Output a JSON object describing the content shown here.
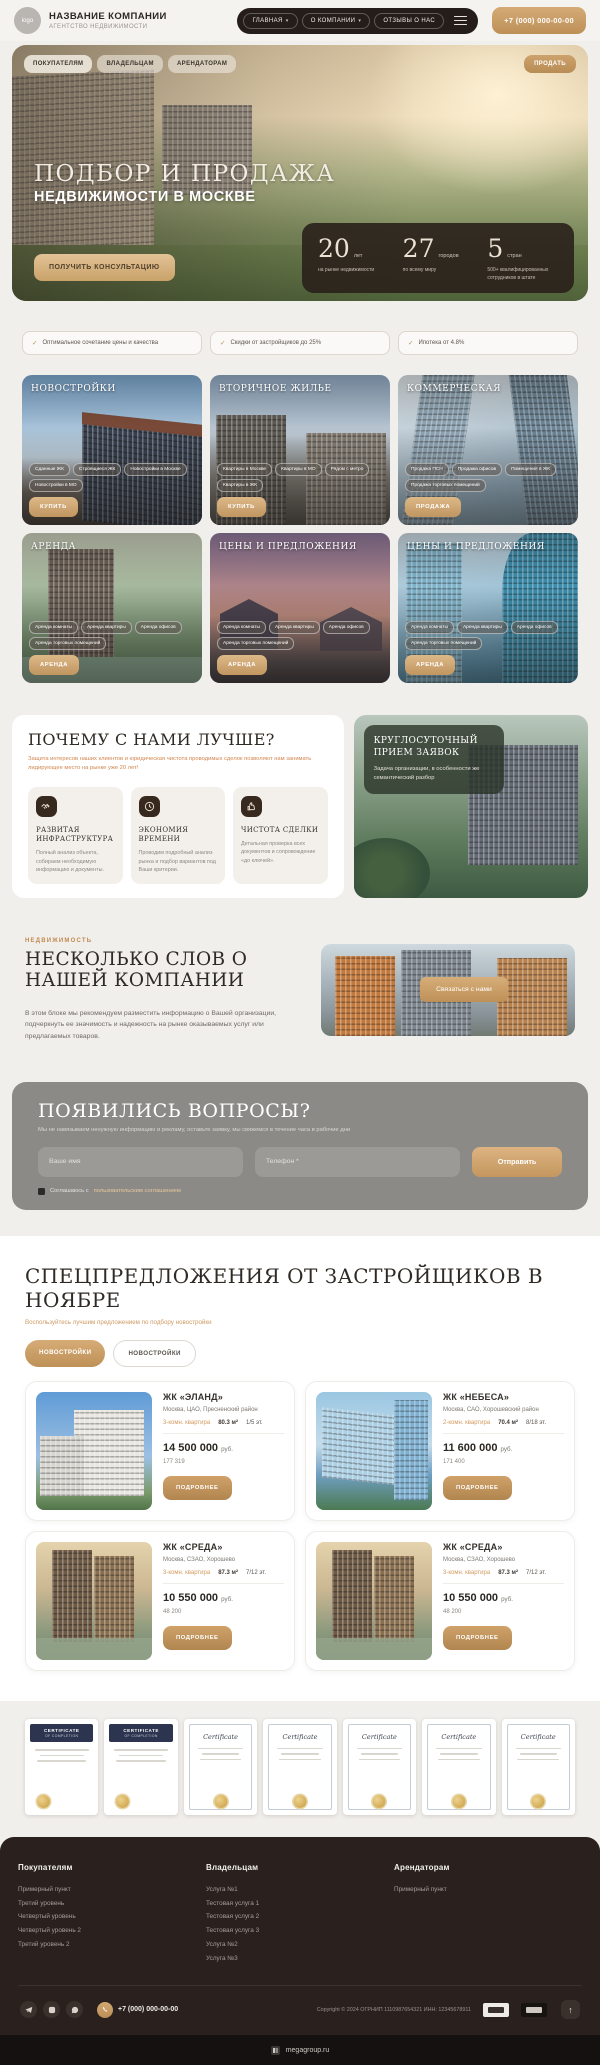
{
  "icons": {
    "check": "✓",
    "caret": "▾",
    "arrow_up": "↑"
  },
  "colors": {
    "accent": "#c79b62",
    "dark_brown": "#2a211e",
    "page_bg": "#f1efec",
    "orange_text": "#d2854e"
  },
  "header": {
    "logo_text": "logo",
    "company_name": "НАЗВАНИЕ КОМПАНИИ",
    "company_tagline": "АГЕНТСТВО НЕДВИЖИМОСТИ",
    "nav": [
      {
        "label": "ГЛАВНАЯ",
        "has_dropdown": true
      },
      {
        "label": "О КОМПАНИИ",
        "has_dropdown": true
      },
      {
        "label": "ОТЗЫВЫ О НАС",
        "has_dropdown": false
      }
    ],
    "phone": "+7 (000) 000-00-00"
  },
  "hero": {
    "subnav": [
      "ПОКУПАТЕЛЯМ",
      "ВЛАДЕЛЬЦАМ",
      "АРЕНДАТОРАМ"
    ],
    "sell_button": "ПРОДАТЬ",
    "title_line1": "ПОДБОР И ПРОДАЖА",
    "title_line2": "НЕДВИЖИМОСТИ В МОСКВЕ",
    "cta": "ПОЛУЧИТЬ КОНСУЛЬТАЦИЮ",
    "stats": [
      {
        "value": "20",
        "unit": "лет",
        "caption": "на рынке недвижимости"
      },
      {
        "value": "27",
        "unit": "городов",
        "caption": "по всему миру"
      },
      {
        "value": "5",
        "unit": "стран",
        "caption": "500+ квалифицированных сотрудников в штате"
      }
    ]
  },
  "badges": [
    "Оптимальное сочетание цены и качества",
    "Скидки от застройщиков до 25%",
    "Ипотека от 4.8%"
  ],
  "categories": [
    {
      "title": "НОВОСТРОЙКИ",
      "tags": [
        "Сданные ЖК",
        "Строящиеся ЖК",
        "Новостройки в Москве",
        "Новостройки в МО"
      ],
      "button": "КУПИТЬ"
    },
    {
      "title": "ВТОРИЧНОЕ ЖИЛЬЕ",
      "tags": [
        "Квартиры в Москве",
        "Квартиры в МО",
        "Рядом с метро",
        "Квартиры в ЖК"
      ],
      "button": "КУПИТЬ"
    },
    {
      "title": "КОММЕРЧЕСКАЯ",
      "tags": [
        "Продажа ПСН",
        "Продажа офисов",
        "Помещения в ЖК",
        "Продажа торговых помещений"
      ],
      "button": "ПРОДАЖА"
    },
    {
      "title": "АРЕНДА",
      "tags": [
        "Аренда комнаты",
        "Аренда квартиры",
        "Аренда офисов",
        "Аренда торговых помещений"
      ],
      "button": "АРЕНДА"
    },
    {
      "title": "ЦЕНЫ И ПРЕДЛОЖЕНИЯ",
      "tags": [
        "Аренда комнаты",
        "Аренда квартиры",
        "Аренда офисов",
        "Аренда торговых помещений"
      ],
      "button": "АРЕНДА"
    },
    {
      "title": "ЦЕНЫ И ПРЕДЛОЖЕНИЯ",
      "tags": [
        "Аренда комнаты",
        "Аренда квартиры",
        "Аренда офисов",
        "Аренда торговых помещений"
      ],
      "button": "АРЕНДА"
    }
  ],
  "why": {
    "title": "ПОЧЕМУ С НАМИ ЛУЧШЕ?",
    "subtitle": "Защита интересов наших клиентов и юридическая чистота проводимых сделок позволяют нам занимать лидирующее место на рынке уже 20 лет!",
    "features": [
      {
        "icon": "handshake-icon",
        "title": "РАЗВИТАЯ ИНФРАСТРУКТУРА",
        "text": "Полный анализ объекта, собираем необходимую информацию и документы."
      },
      {
        "icon": "clock-icon",
        "title": "ЭКОНОМИЯ ВРЕМЕНИ",
        "text": "Проводим подробный анализ рынка и подбор вариантов под Ваши критерии."
      },
      {
        "icon": "thumbs-up-icon",
        "title": "ЧИСТОТА СДЕЛКИ",
        "text": "Детальная проверка всех документов и сопровождение «до ключей»."
      }
    ],
    "promo": {
      "title": "КРУГЛОСУТОЧНЫЙ ПРИЕМ ЗАЯВОК",
      "text": "Задача организации, в особенности же семантический разбор"
    }
  },
  "about": {
    "eyebrow": "НЕДВИЖИМОСТЬ",
    "title": "НЕСКОЛЬКО СЛОВ О НАШЕЙ КОМПАНИИ",
    "text": "В этом блоке мы рекомендуем разместить информацию о Вашей организации, подчеркнуть ее значимость и надежность на рынке оказываемых услуг или предлагаемых товаров.",
    "button": "Связаться с нами"
  },
  "form": {
    "title": "ПОЯВИЛИСЬ ВОПРОСЫ?",
    "subtitle": "Мы не навязываем ненужную информацию и рекламу, оставьте заявку, мы свяжемся в течение часа в рабочие дни",
    "name_placeholder": "Ваше имя",
    "phone_placeholder": "Телефон *",
    "submit": "Отправить",
    "consent_prefix": "Соглашаюсь с",
    "consent_link": "пользовательским соглашением"
  },
  "offers": {
    "title": "СПЕЦПРЕДЛОЖЕНИЯ ОТ ЗАСТРОЙЩИКОВ В НОЯБРЕ",
    "subtitle": "Воспользуйтесь лучшим предложением по подбору новостройки",
    "tabs": [
      {
        "label": "НОВОСТРОЙКИ",
        "active": true
      },
      {
        "label": "НОВОСТРОЙКИ",
        "active": false
      }
    ],
    "cards": [
      {
        "name": "ЖК «ЭЛАНД»",
        "location": "Москва, ЦАО, Пресненский район",
        "rooms": "3-комн. квартира",
        "area": "80.3 м²",
        "floor": "1/5 эт.",
        "price": "14 500 000",
        "currency": "руб.",
        "per_m": "177 319",
        "button": "ПОДРОБНЕЕ"
      },
      {
        "name": "ЖК «НЕБЕСА»",
        "location": "Москва, САО, Хорошевский район",
        "rooms": "2-комн. квартира",
        "area": "70.4 м²",
        "floor": "8/18 эт.",
        "price": "11 600 000",
        "currency": "руб.",
        "per_m": "171 400",
        "button": "ПОДРОБНЕЕ"
      },
      {
        "name": "ЖК «СРЕДА»",
        "location": "Москва, СЗАО, Хорошево",
        "rooms": "3-комн. квартира",
        "area": "87.3 м²",
        "floor": "7/12 эт.",
        "price": "10 550 000",
        "currency": "руб.",
        "per_m": "48 200",
        "button": "ПОДРОБНЕЕ"
      },
      {
        "name": "ЖК «СРЕДА»",
        "location": "Москва, СЗАО, Хорошево",
        "rooms": "3-комн. квартира",
        "area": "87.3 м²",
        "floor": "7/12 эт.",
        "price": "10 550 000",
        "currency": "руб.",
        "per_m": "48 200",
        "button": "ПОДРОБНЕЕ"
      }
    ]
  },
  "certificates": {
    "dark_title": "CERTIFICATE",
    "dark_sub": "OF COMPLETION",
    "ornate_title": "Certificate"
  },
  "footer": {
    "columns": [
      {
        "title": "Покупателям",
        "links": [
          "Примерный пункт",
          "Третий уровень",
          "Четвертый уровень",
          "Четвертый уровень 2",
          "Третий уровень 2"
        ]
      },
      {
        "title": "Владельцам",
        "links": [
          "Услуга №1",
          "Тестовая услуга 1",
          "Тестовая услуга 2",
          "Тестовая услуга 3",
          "Услуга №2",
          "Услуга №3"
        ]
      },
      {
        "title": "Арендаторам",
        "links": [
          "Примерный пункт"
        ]
      }
    ],
    "phone": "+7 (000) 000-00-00",
    "copyright": "Copyright © 2024  ОГРНИП 1110987654321  ИНН: 12345678911",
    "builder": "megagroup.ru"
  }
}
